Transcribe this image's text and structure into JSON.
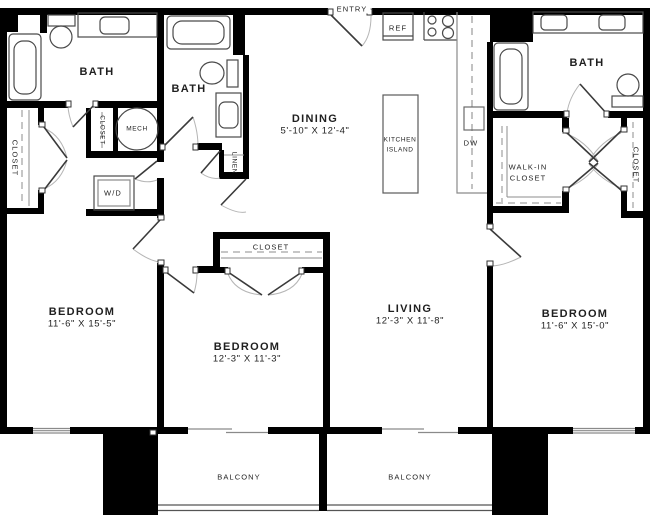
{
  "plan": {
    "entry_label": "ENTRY",
    "rooms": {
      "dining": {
        "name": "DINING",
        "dims": "5'-10\" X 12'-4\""
      },
      "living": {
        "name": "LIVING",
        "dims": "12'-3\" X 11'-8\""
      },
      "bedroom_left": {
        "name": "BEDROOM",
        "dims": "11'-6\" X 15'-5\""
      },
      "bedroom_middle": {
        "name": "BEDROOM",
        "dims": "12'-3\" X 11'-3\""
      },
      "bedroom_right": {
        "name": "BEDROOM",
        "dims": "11'-6\" X 15'-0\""
      },
      "bath_left": {
        "name": "BATH"
      },
      "bath_middle": {
        "name": "BATH"
      },
      "bath_right": {
        "name": "BATH"
      },
      "walk_in_closet": {
        "line1": "WALK-IN",
        "line2": "CLOSET"
      },
      "closet_left": {
        "name": "CLOSET"
      },
      "closet_hall": {
        "name": "CLOSET"
      },
      "closet_middle": {
        "name": "CLOSET"
      },
      "closet_right": {
        "name": "CLOSET"
      },
      "linen": {
        "name": "LINEN"
      },
      "mech": {
        "name": "MECH"
      },
      "laundry": {
        "name": "W/D"
      },
      "kitchen_island": {
        "line1": "KITCHEN",
        "line2": "ISLAND"
      },
      "balcony_left": {
        "name": "BALCONY"
      },
      "balcony_right": {
        "name": "BALCONY"
      }
    },
    "appliances": {
      "ref": "REF",
      "dw": "DW"
    },
    "colors": {
      "wall": "#000000",
      "fixture": "#4a4a4a",
      "arc": "#b0b0b0",
      "background": "#ffffff"
    }
  }
}
